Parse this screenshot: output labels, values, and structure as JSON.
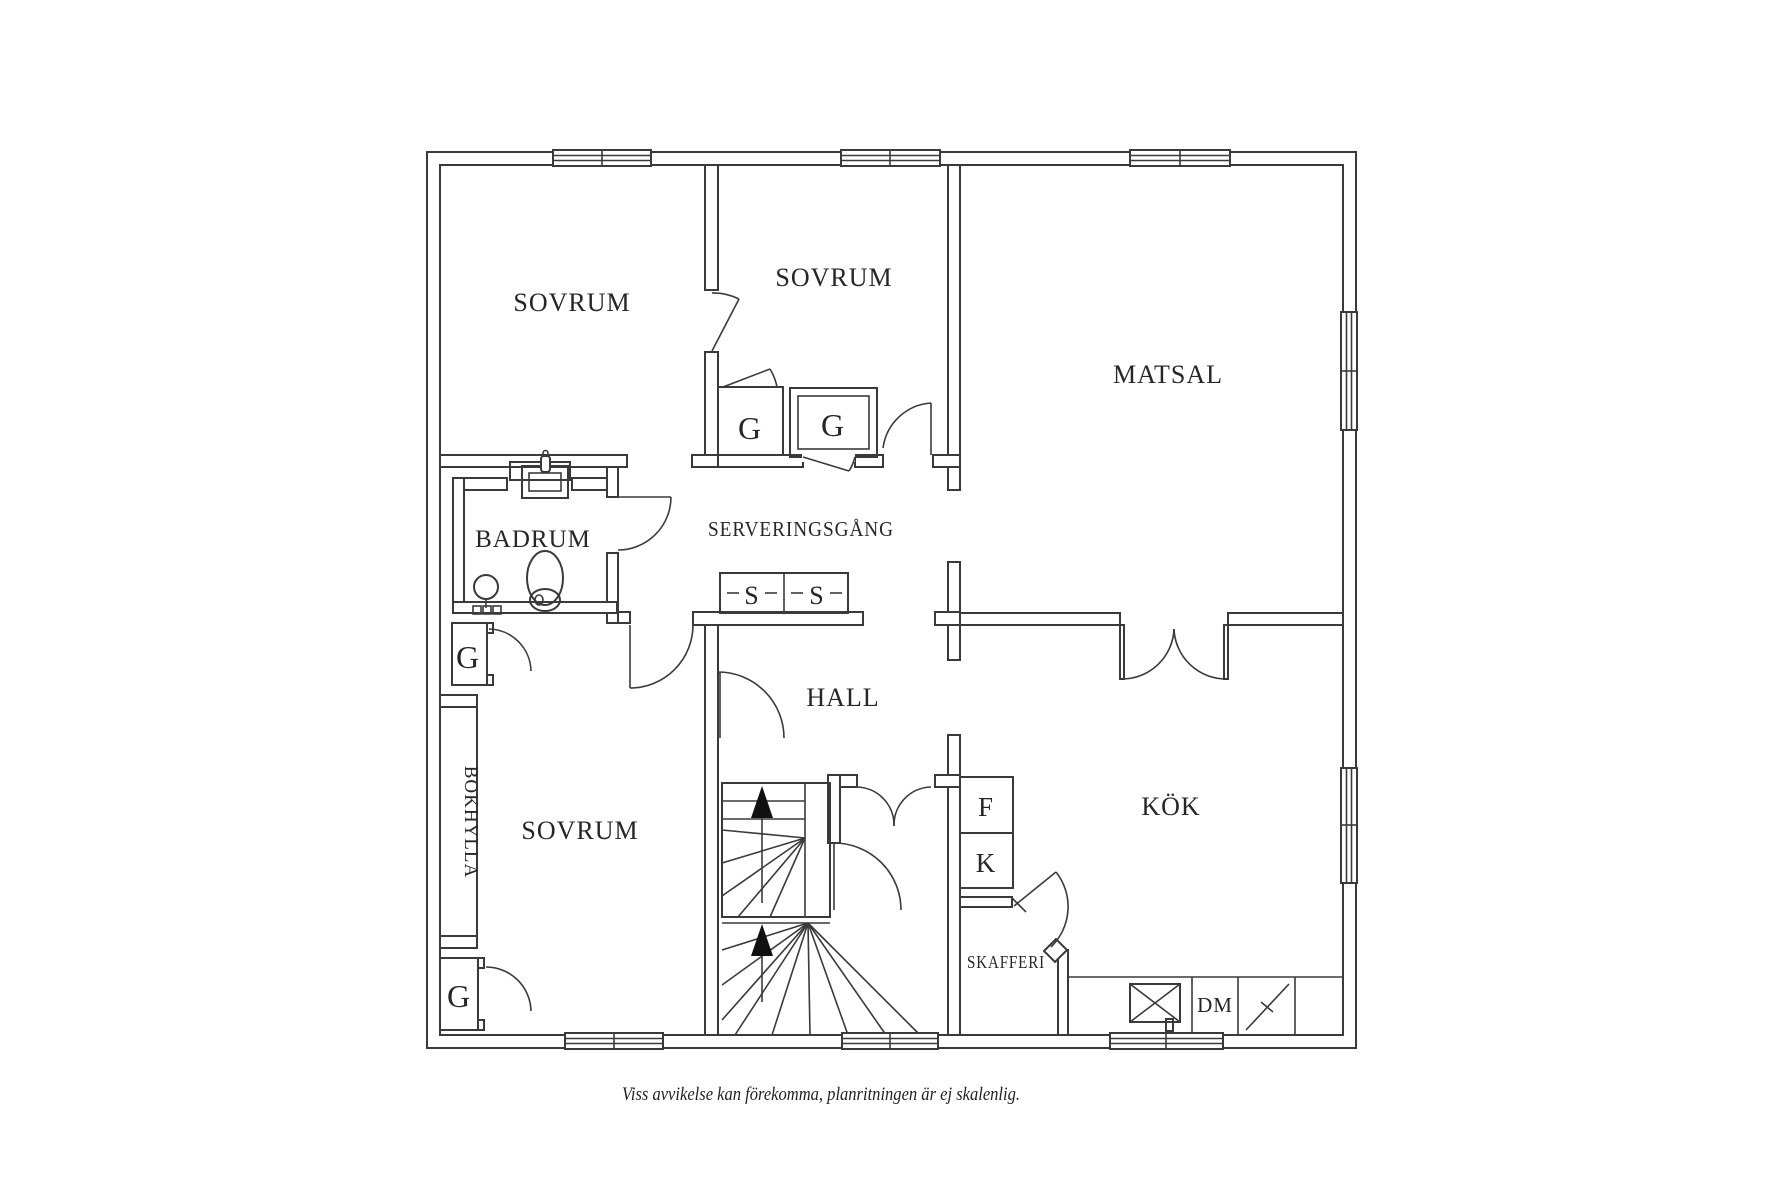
{
  "floorplan": {
    "rooms": {
      "bedroom_top_left": "SOVRUM",
      "bedroom_top_middle": "SOVRUM",
      "bedroom_bottom": "SOVRUM",
      "dining_room": "MATSAL",
      "bathroom": "BADRUM",
      "serving_corridor": "SERVERINGSGÅNG",
      "hall": "HALL",
      "kitchen": "KÖK",
      "pantry": "SKAFFERI",
      "bookshelf": "BOKHYLLA"
    },
    "markers": {
      "wardrobe": "G",
      "cabinet": "S",
      "freezer": "F",
      "fridge": "K",
      "dishwasher": "DM"
    },
    "caption": "Viss avvikelse kan förekomma, planritningen är ej skalenlig.",
    "colors": {
      "line": "#3a3a3a",
      "text": "#262626",
      "background": "#ffffff"
    }
  }
}
